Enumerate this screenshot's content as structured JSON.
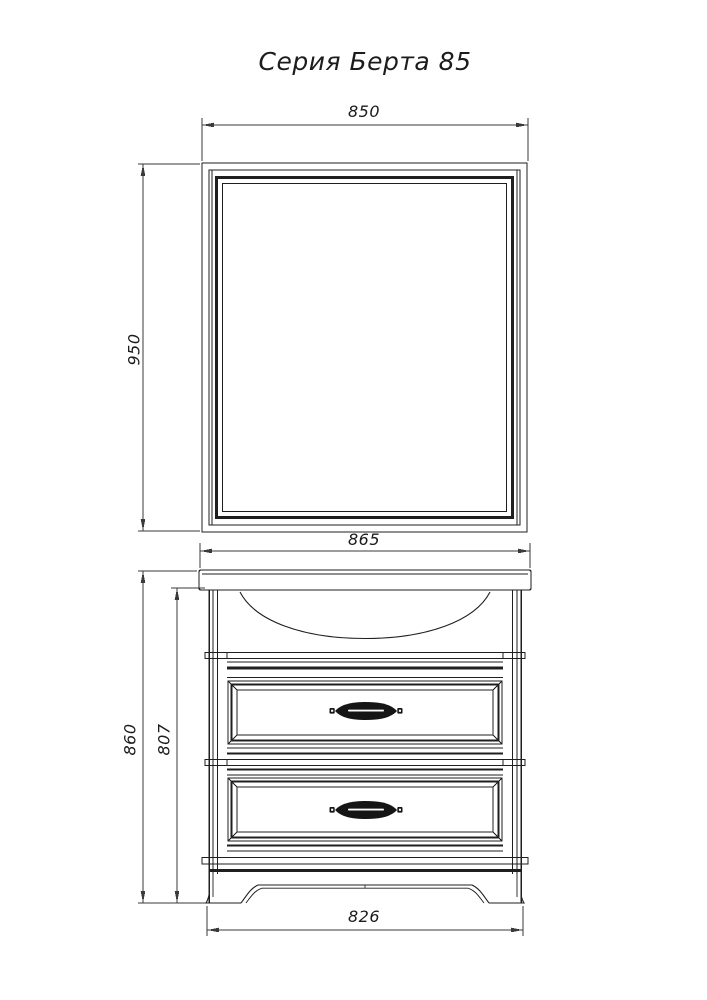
{
  "title": "Серия Берта 85",
  "dimensions": {
    "mirror_width_mm": "850",
    "mirror_height_mm": "950",
    "washbasin_width_mm": "865",
    "total_height_mm": "860",
    "cabinet_height_mm": "807",
    "base_width_mm": "826"
  },
  "colors": {
    "background": "#ffffff",
    "drawing_line": "#1f1f1f",
    "dimension_line": "#3a3a3a",
    "handle_fill": "#151515",
    "text": "#1c1c1c"
  }
}
